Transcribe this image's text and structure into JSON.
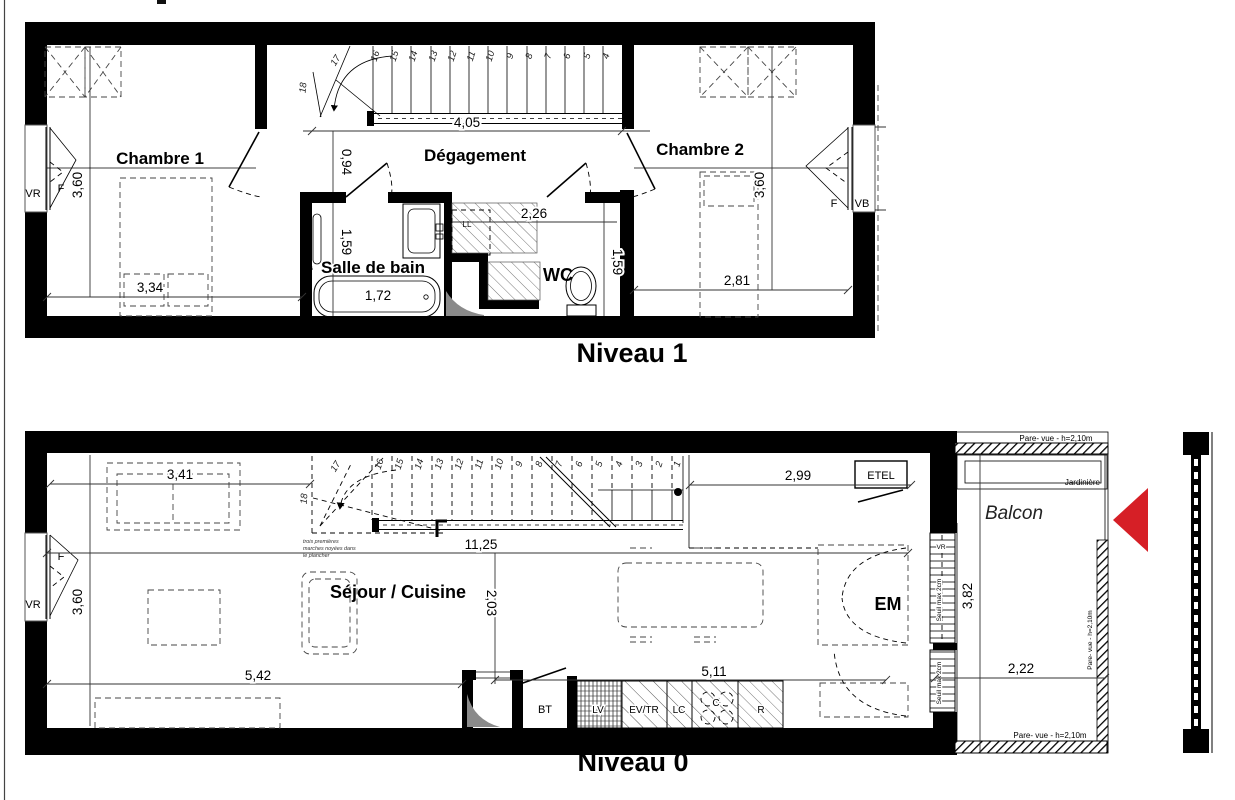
{
  "colors": {
    "accent_red": "#d61f26",
    "line": "#000000",
    "sweep_gray": "#8a8a8a"
  },
  "niveau1": {
    "title": "Niveau 1",
    "rooms": {
      "chambre1": "Chambre 1",
      "degagement": "Dégagement",
      "salle_de_bain": "Salle de bain",
      "wc": "WC",
      "chambre2": "Chambre 2"
    },
    "openings": {
      "left_vr": "VR",
      "left_f": "F",
      "right_f": "F",
      "right_vb": "VB"
    },
    "fixtures": {
      "ll": "LL",
      "s": "s"
    },
    "dims": {
      "stairs_w": "4,05",
      "ch1_h": "3,60",
      "ch1_w": "3,34",
      "deg": "0,94",
      "sdb_h": "1,59",
      "bath": "1,72",
      "wc_w": "2,26",
      "wc_h": "1,59",
      "ch2_w": "2,81",
      "ch2_h": "3,60"
    },
    "steps": {
      "s18": "18",
      "s17": "17",
      "s16": "16",
      "s15": "15",
      "s14": "14",
      "s13": "13",
      "s12": "12",
      "s11": "11",
      "s10": "10",
      "s9": "9",
      "s8": "8",
      "s7": "7",
      "s6": "6",
      "s5": "5",
      "s4": "4"
    }
  },
  "niveau0": {
    "title": "Niveau 0",
    "rooms": {
      "sejour": "Séjour / Cuisine",
      "balcon": "Balcon"
    },
    "openings": {
      "left_vr": "VR",
      "left_f": "F",
      "right_vr": "VR"
    },
    "labels": {
      "etel": "ETEL",
      "em": "EM",
      "bt": "BT",
      "lv": "LV",
      "evtr": "EV/TR",
      "lc": "LC",
      "c": "C",
      "r": "R",
      "jardiniere": "Jardinière"
    },
    "notes": {
      "pare_vue_top": "Pare- vue - h=2,10m",
      "pare_vue_right": "Pare- vue - h=2,10m",
      "pare_vue_bottom": "Pare- vue - h=2,10m",
      "seuil_top": "Seuil max 2cm",
      "seuil_bottom": "Seuil max 2cm",
      "stair_note_1": "trois premières",
      "stair_note_2": "marches noyées dans",
      "stair_note_3": "le plancher"
    },
    "dims": {
      "sofa": "3,41",
      "right": "2,99",
      "total": "11,25",
      "left_h": "3,60",
      "mid_h": "2,03",
      "bottom_left": "5,42",
      "kitchen": "5,11",
      "balcony_h": "3,82",
      "balcony_w": "2,22"
    },
    "steps": {
      "s18": "18",
      "s17": "17",
      "s16": "16",
      "s15": "15",
      "s14": "14",
      "s13": "13",
      "s12": "12",
      "s11": "11",
      "s10": "10",
      "s9": "9",
      "s8": "8",
      "s7": "7",
      "s6": "6",
      "s5": "5",
      "s4": "4",
      "s3": "3",
      "s2": "2",
      "s1": "1"
    }
  }
}
